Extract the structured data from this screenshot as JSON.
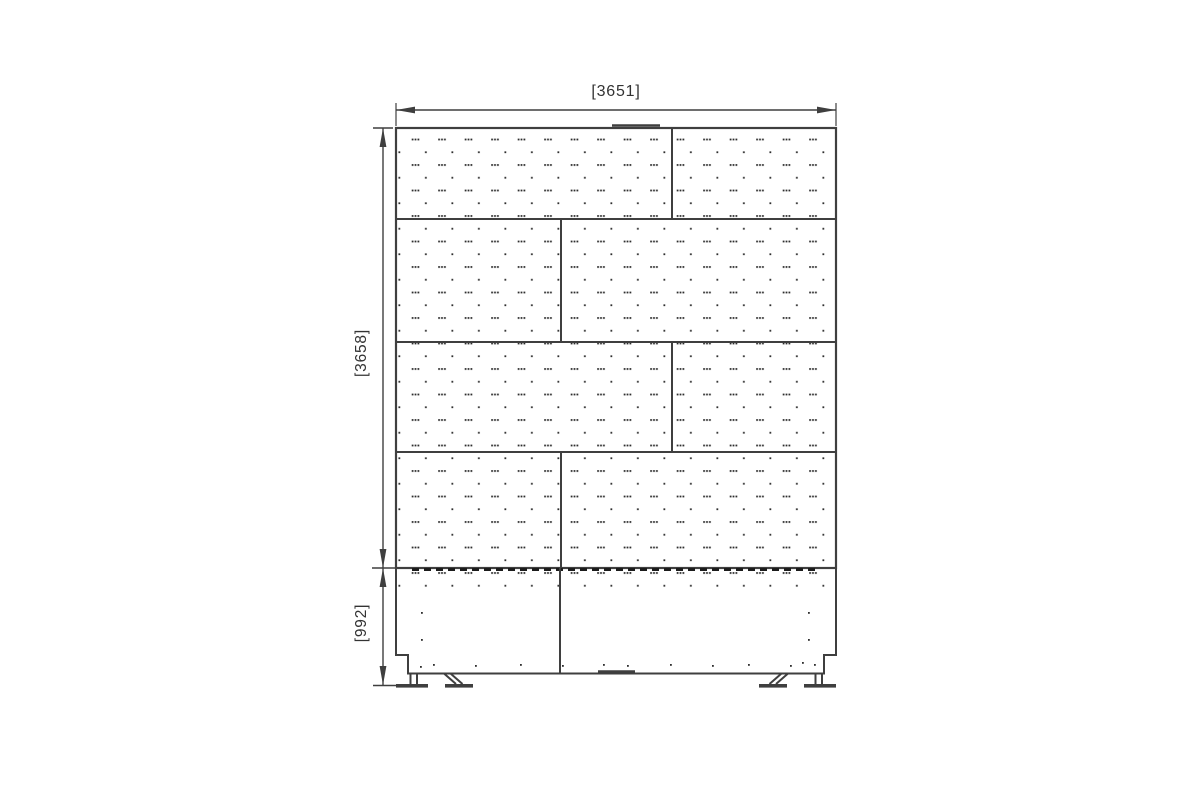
{
  "dimensions": {
    "width": "[3651]",
    "height": "[3658]",
    "base_height": "[992]"
  },
  "colors": {
    "line": "#3f3f3f",
    "dash": "#1c1c1c",
    "dot": "#2e2e2e",
    "text": "#333333",
    "background": "#ffffff"
  },
  "drawing": {
    "stroke_color": "#3f3f3f",
    "dot_color": "#2e2e2e",
    "rects": [
      {
        "x": 396,
        "y": 128,
        "w": 440,
        "h": 440,
        "fill": "perf",
        "stroke": true,
        "sw": 2.2
      },
      {
        "x": 398,
        "y": 569,
        "w": 436,
        "h": 27,
        "fill": "perf"
      },
      {
        "x": 396,
        "y": 684,
        "w": 32,
        "h": 3.6,
        "fill": "solid"
      },
      {
        "x": 445,
        "y": 684,
        "w": 28,
        "h": 3.6,
        "fill": "solid"
      },
      {
        "x": 759,
        "y": 684,
        "w": 28,
        "h": 3.6,
        "fill": "solid"
      },
      {
        "x": 804,
        "y": 684,
        "w": 32,
        "h": 3.6,
        "fill": "solid"
      }
    ],
    "paths": [
      {
        "d": "M396,568 L396,655 L408,655 L408,673.5 L824,673.5 L824,655 L836,655 L836,568",
        "w": 2
      }
    ],
    "lines": [
      {
        "x1": 396,
        "y1": 219,
        "x2": 836,
        "y2": 219
      },
      {
        "x1": 396,
        "y1": 342,
        "x2": 836,
        "y2": 342
      },
      {
        "x1": 396,
        "y1": 452,
        "x2": 836,
        "y2": 452
      },
      {
        "x1": 672,
        "y1": 128,
        "x2": 672,
        "y2": 219
      },
      {
        "x1": 561,
        "y1": 219,
        "x2": 561,
        "y2": 342
      },
      {
        "x1": 672,
        "y1": 342,
        "x2": 672,
        "y2": 452
      },
      {
        "x1": 561,
        "y1": 452,
        "x2": 561,
        "y2": 568
      },
      {
        "x1": 612,
        "y1": 125.5,
        "x2": 660,
        "y2": 125.5,
        "w": 2.5
      },
      {
        "x1": 412,
        "y1": 569.5,
        "x2": 820,
        "y2": 569.5,
        "w": 3,
        "dash": "7 5",
        "color": "#1c1c1c"
      },
      {
        "x1": 560,
        "y1": 568,
        "x2": 560,
        "y2": 673.5
      },
      {
        "x1": 598,
        "y1": 671.5,
        "x2": 635,
        "y2": 671.5,
        "w": 2.4
      },
      {
        "x1": 410.5,
        "y1": 673.5,
        "x2": 410.5,
        "y2": 684
      },
      {
        "x1": 417,
        "y1": 673.5,
        "x2": 417,
        "y2": 684
      },
      {
        "x1": 444,
        "y1": 673.5,
        "x2": 456,
        "y2": 684
      },
      {
        "x1": 450.5,
        "y1": 673.5,
        "x2": 462.5,
        "y2": 684
      },
      {
        "x1": 788,
        "y1": 673.5,
        "x2": 776,
        "y2": 684
      },
      {
        "x1": 781.5,
        "y1": 673.5,
        "x2": 769.5,
        "y2": 684
      },
      {
        "x1": 815.5,
        "y1": 673.5,
        "x2": 815.5,
        "y2": 684
      },
      {
        "x1": 822,
        "y1": 673.5,
        "x2": 822,
        "y2": 684
      },
      {
        "x1": 396,
        "y1": 110,
        "x2": 836,
        "y2": 110,
        "w": 1.4
      },
      {
        "x1": 396,
        "y1": 103,
        "x2": 396,
        "y2": 126,
        "w": 1.2
      },
      {
        "x1": 836,
        "y1": 103,
        "x2": 836,
        "y2": 126,
        "w": 1.2
      },
      {
        "x1": 383,
        "y1": 128,
        "x2": 383,
        "y2": 685,
        "w": 1.4
      },
      {
        "x1": 373,
        "y1": 128,
        "x2": 393,
        "y2": 128,
        "w": 1.6
      },
      {
        "x1": 372,
        "y1": 568,
        "x2": 395,
        "y2": 568,
        "w": 1.6
      },
      {
        "x1": 373,
        "y1": 685.5,
        "x2": 397,
        "y2": 685.5,
        "w": 1.6
      }
    ],
    "polys": [
      {
        "pts": "396,110 415,106.6 415,113.4"
      },
      {
        "pts": "836,110 817,106.6 817,113.4"
      },
      {
        "pts": "383,128 379.6,147 386.4,147"
      },
      {
        "pts": "383,568 379.6,549 386.4,549"
      },
      {
        "pts": "383,568 379.6,587 386.4,587"
      },
      {
        "pts": "383,685 379.6,666 386.4,666"
      }
    ],
    "dots": [
      [
        421,
        612
      ],
      [
        421,
        639
      ],
      [
        808,
        612
      ],
      [
        808,
        639
      ],
      [
        420,
        666
      ],
      [
        433,
        664
      ],
      [
        475,
        665
      ],
      [
        520,
        664
      ],
      [
        562,
        665
      ],
      [
        603,
        664
      ],
      [
        627,
        665
      ],
      [
        670,
        664
      ],
      [
        712,
        665
      ],
      [
        748,
        664
      ],
      [
        790,
        665
      ],
      [
        802,
        662
      ],
      [
        814,
        664
      ]
    ]
  }
}
